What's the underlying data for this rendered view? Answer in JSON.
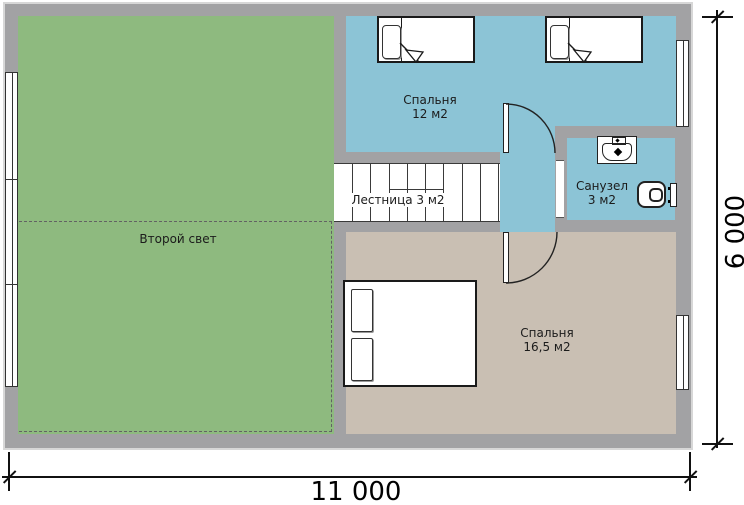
{
  "rooms": {
    "second_light": {
      "label": "Второй свет"
    },
    "bedroom_small": {
      "label": "Спальня",
      "area": "12 м2"
    },
    "stairs": {
      "label": "Лестница 3 м2",
      "treads": 9
    },
    "bathroom": {
      "label": "Санузел",
      "area": "3 м2"
    },
    "bedroom_large": {
      "label": "Спальня",
      "area": "16,5 м2"
    }
  },
  "dimensions": {
    "width": "11 000",
    "height": "6 000"
  },
  "colors": {
    "wall": "#a2a2a4",
    "second_light_floor": "#8eba7f",
    "wet_blue_floor": "#8cc4d6",
    "bedroom_large_floor": "#c9bfb3",
    "stairs_floor": "#ffffff"
  },
  "furniture_icons": [
    "single-bed-icon",
    "single-bed-icon",
    "double-bed-icon",
    "sink-icon",
    "toilet-icon"
  ]
}
